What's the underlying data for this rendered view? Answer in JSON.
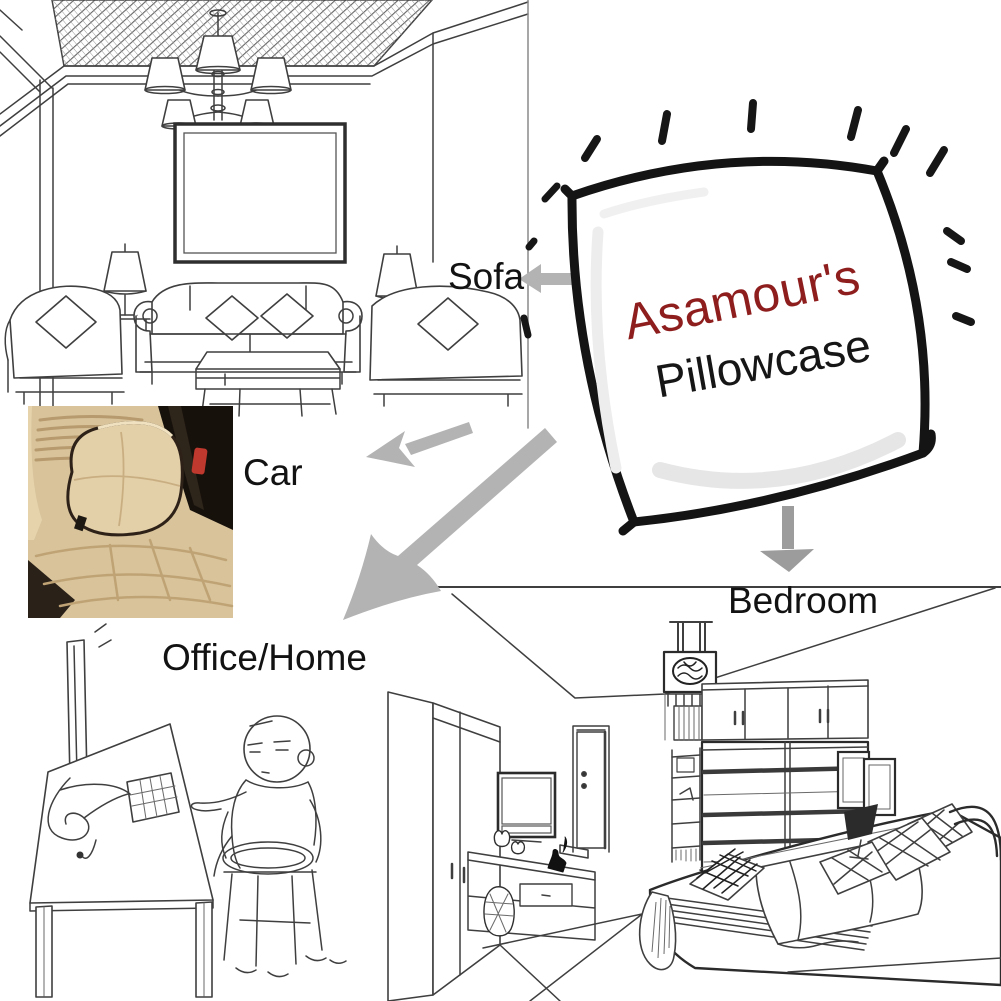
{
  "pillow": {
    "brand": "Asamour's",
    "product": "Pillowcase",
    "brand_color": "#8e1e1e",
    "product_color": "#161616",
    "outline_color": "#141414"
  },
  "labels": {
    "sofa": "Sofa",
    "car": "Car",
    "office_home": "Office/Home",
    "bedroom": "Bedroom"
  },
  "colors": {
    "background": "#ffffff",
    "arrow_gray": "#b3b3b3",
    "down_arrow_gray": "#9c9c9c",
    "line_art": "#3f3f3f",
    "car_seat_beige": "#d8c39b",
    "car_pillow_beige": "#e3cfa8",
    "car_console_dark": "#17110c",
    "car_buckle_red": "#c0392e"
  }
}
